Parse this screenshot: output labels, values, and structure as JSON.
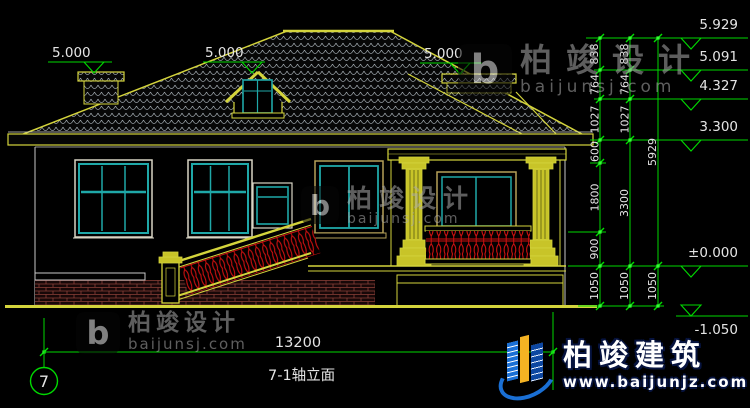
{
  "sheet": {
    "axis_number": "7",
    "view_title": "7-1轴立面",
    "overall_width": "13200"
  },
  "levels": {
    "ridge": "5.929",
    "upper_break": "5.091",
    "eave": "4.327",
    "wall_top": "3.300",
    "floor": "±0.000",
    "ground": "-1.050",
    "left_chimney_top": "5.000",
    "dormer_top": "5.000",
    "right_chimney_top": "5.000"
  },
  "dim_chains": {
    "inner": [
      "838",
      "764",
      "1027",
      "600",
      "1800",
      "900",
      "1050"
    ],
    "middle": [
      "838",
      "764",
      "1027",
      "3300",
      "1050"
    ],
    "outer": [
      "5929",
      "1050"
    ]
  },
  "watermarks": {
    "studio_name": "柏竣设计",
    "studio_site": "baijunsj.com",
    "studio_monogram": "b",
    "company_name": "柏竣建筑",
    "company_site": "www.baijunjz.com"
  },
  "colors": {
    "cad_yellow": "#d4d43c",
    "dim_green": "#00d900",
    "window_teal": "#1fa8a8",
    "baluster_red": "#cc1010",
    "title_orange": "#ff9900"
  }
}
